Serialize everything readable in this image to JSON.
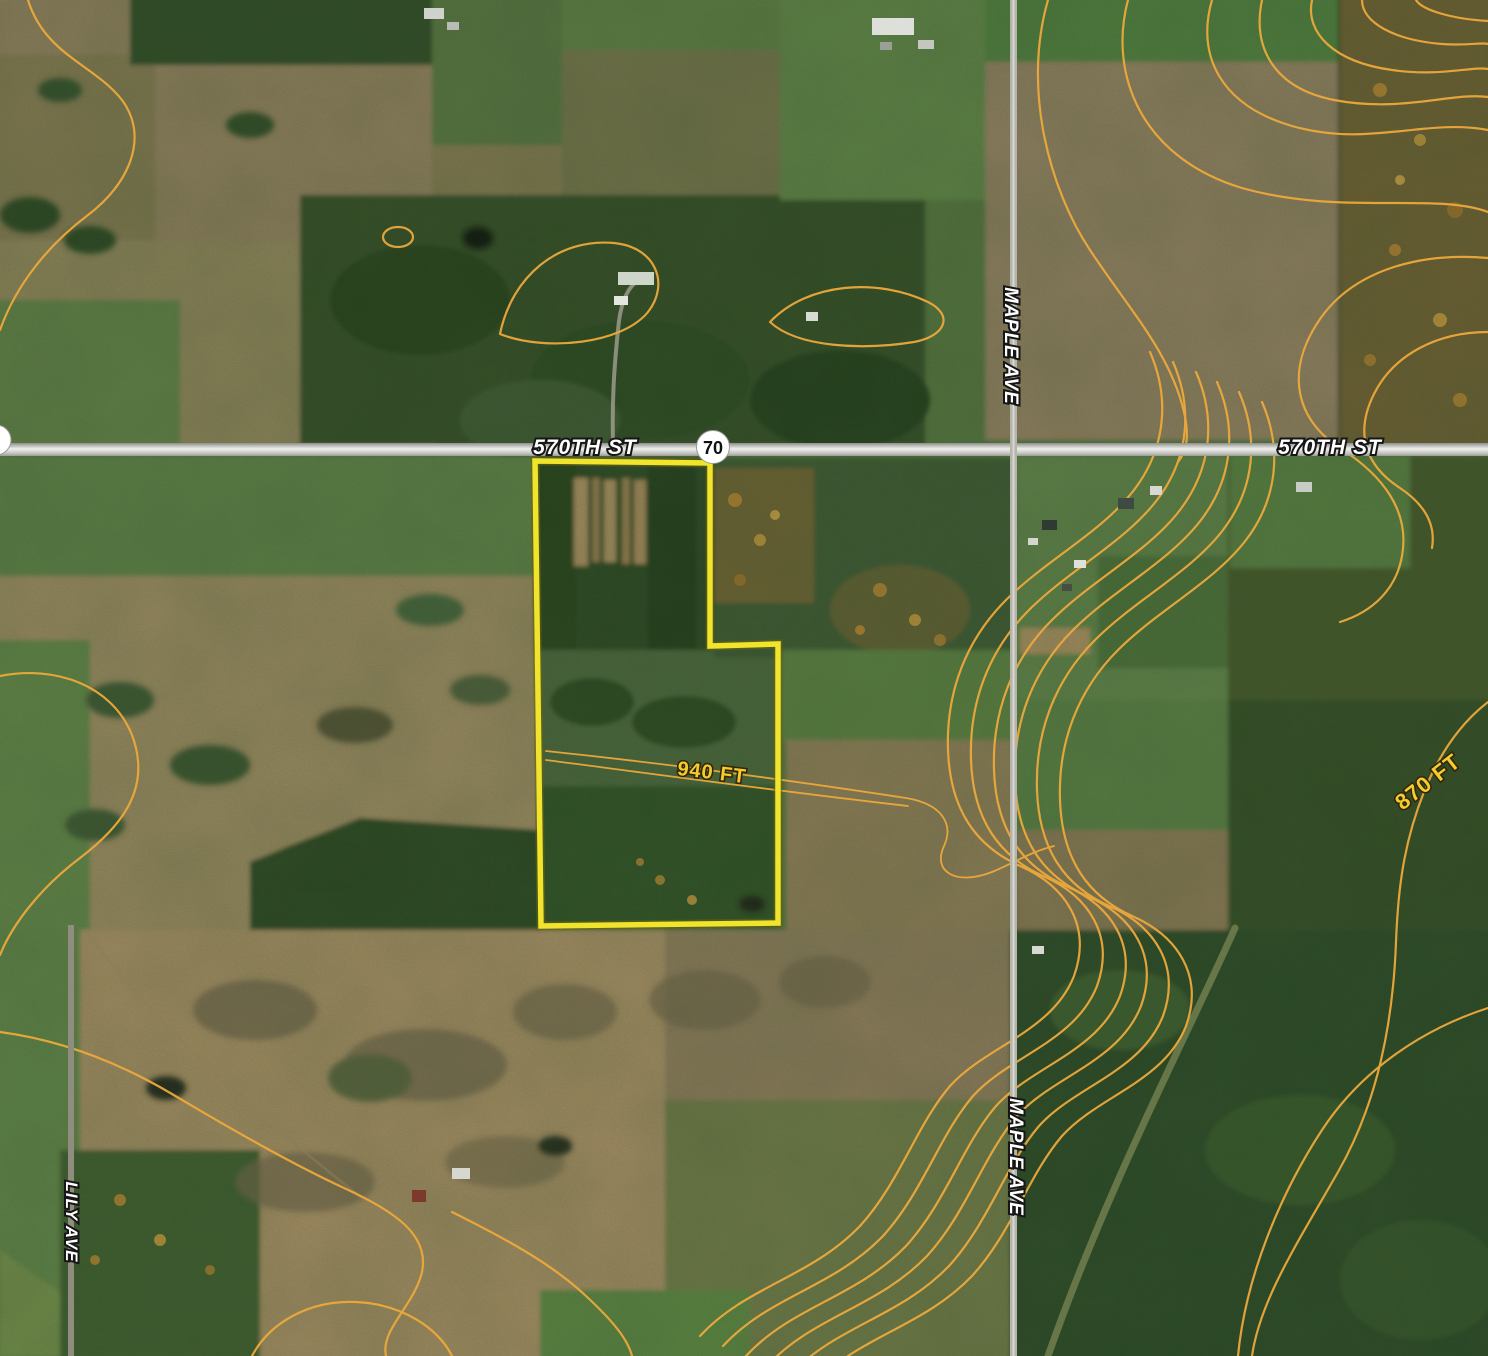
{
  "map": {
    "title": "Aerial parcel map with topographic contours",
    "roads": {
      "st570_left": {
        "label": "570TH ST"
      },
      "st570_right": {
        "label": "570TH ST"
      },
      "maple_top": {
        "label": "MAPLE AVE"
      },
      "maple_bottom": {
        "label": "MAPLE AVE"
      },
      "lily": {
        "label": "LILY AVE"
      }
    },
    "highway_shield": {
      "number": "70"
    },
    "elevation": {
      "label_940": "940 FT",
      "label_870": "870 FT"
    },
    "parcel": {
      "outline_color": "#f1e42d"
    },
    "colors": {
      "contour": "#eda93c",
      "elevation_text": "#f4cd2d",
      "road_label_text": "#ffffff",
      "road_fill": "#c7c7c3"
    }
  }
}
